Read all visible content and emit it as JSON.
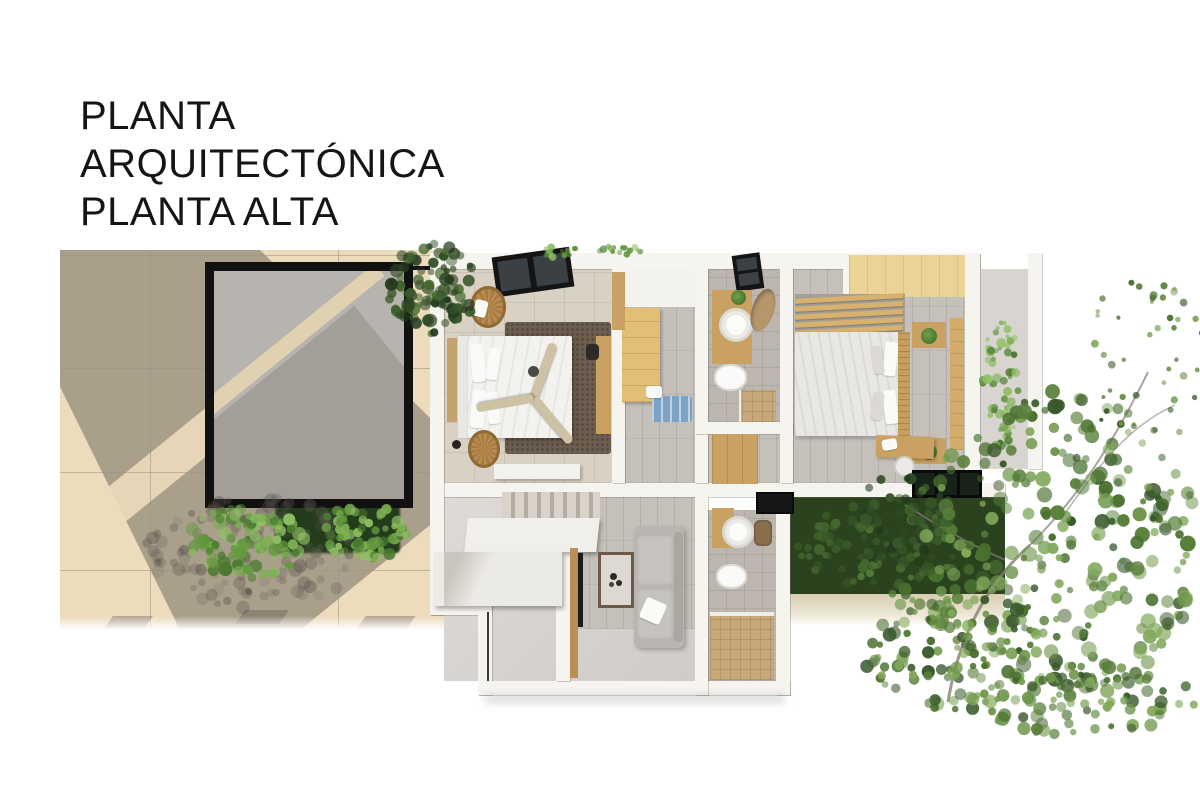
{
  "title": {
    "line1": "PLANTA",
    "line2": "ARQUITECTÓNICA",
    "line3": "PLANTA ALTA"
  },
  "colors": {
    "paper": "#ffffff",
    "ink": "#151515",
    "terrace_paving": "#ecdcbb",
    "cast_shadow": "#9a938c",
    "void_frame": "#111111",
    "void_concrete": "#b7b3ae",
    "wall": "#f6f4ef",
    "bedroom_tile": "#d9d1c4",
    "plank_tile": "#c5c0b9",
    "bath_tile": "#bcb6af",
    "shower_tile": "#c6a87a",
    "wood": "#c9a263",
    "wood_light": "#e2bf75",
    "plywood_deck": "#ead395",
    "rug": "#6b5e4e",
    "bedding_white": "#f3f2ef",
    "bedding_grey": "#e9e7e3",
    "sofa": "#b9b6b2",
    "tv": "#1c1c1c",
    "suitcase_blue": "#7ca3c4",
    "garden_lawn": "#2a421e",
    "garden_path": "#d9cdb2",
    "foliage": {
      "tree": [
        "#39592b",
        "#49702f",
        "#587f3a",
        "#6d9549",
        "#82a85c"
      ],
      "dark": [
        "#24391d",
        "#2f4a24",
        "#3a5a2b",
        "#46692f"
      ],
      "bush": [
        "#4a7a2f",
        "#63993f",
        "#7bb052",
        "#8fbf63"
      ],
      "gardenTex": [
        "#3a5a28",
        "#456a2e",
        "#527a36"
      ],
      "shade": [
        "rgba(98,90,83,0.40)",
        "rgba(110,102,94,0.32)",
        "rgba(88,80,74,0.45)"
      ]
    }
  }
}
